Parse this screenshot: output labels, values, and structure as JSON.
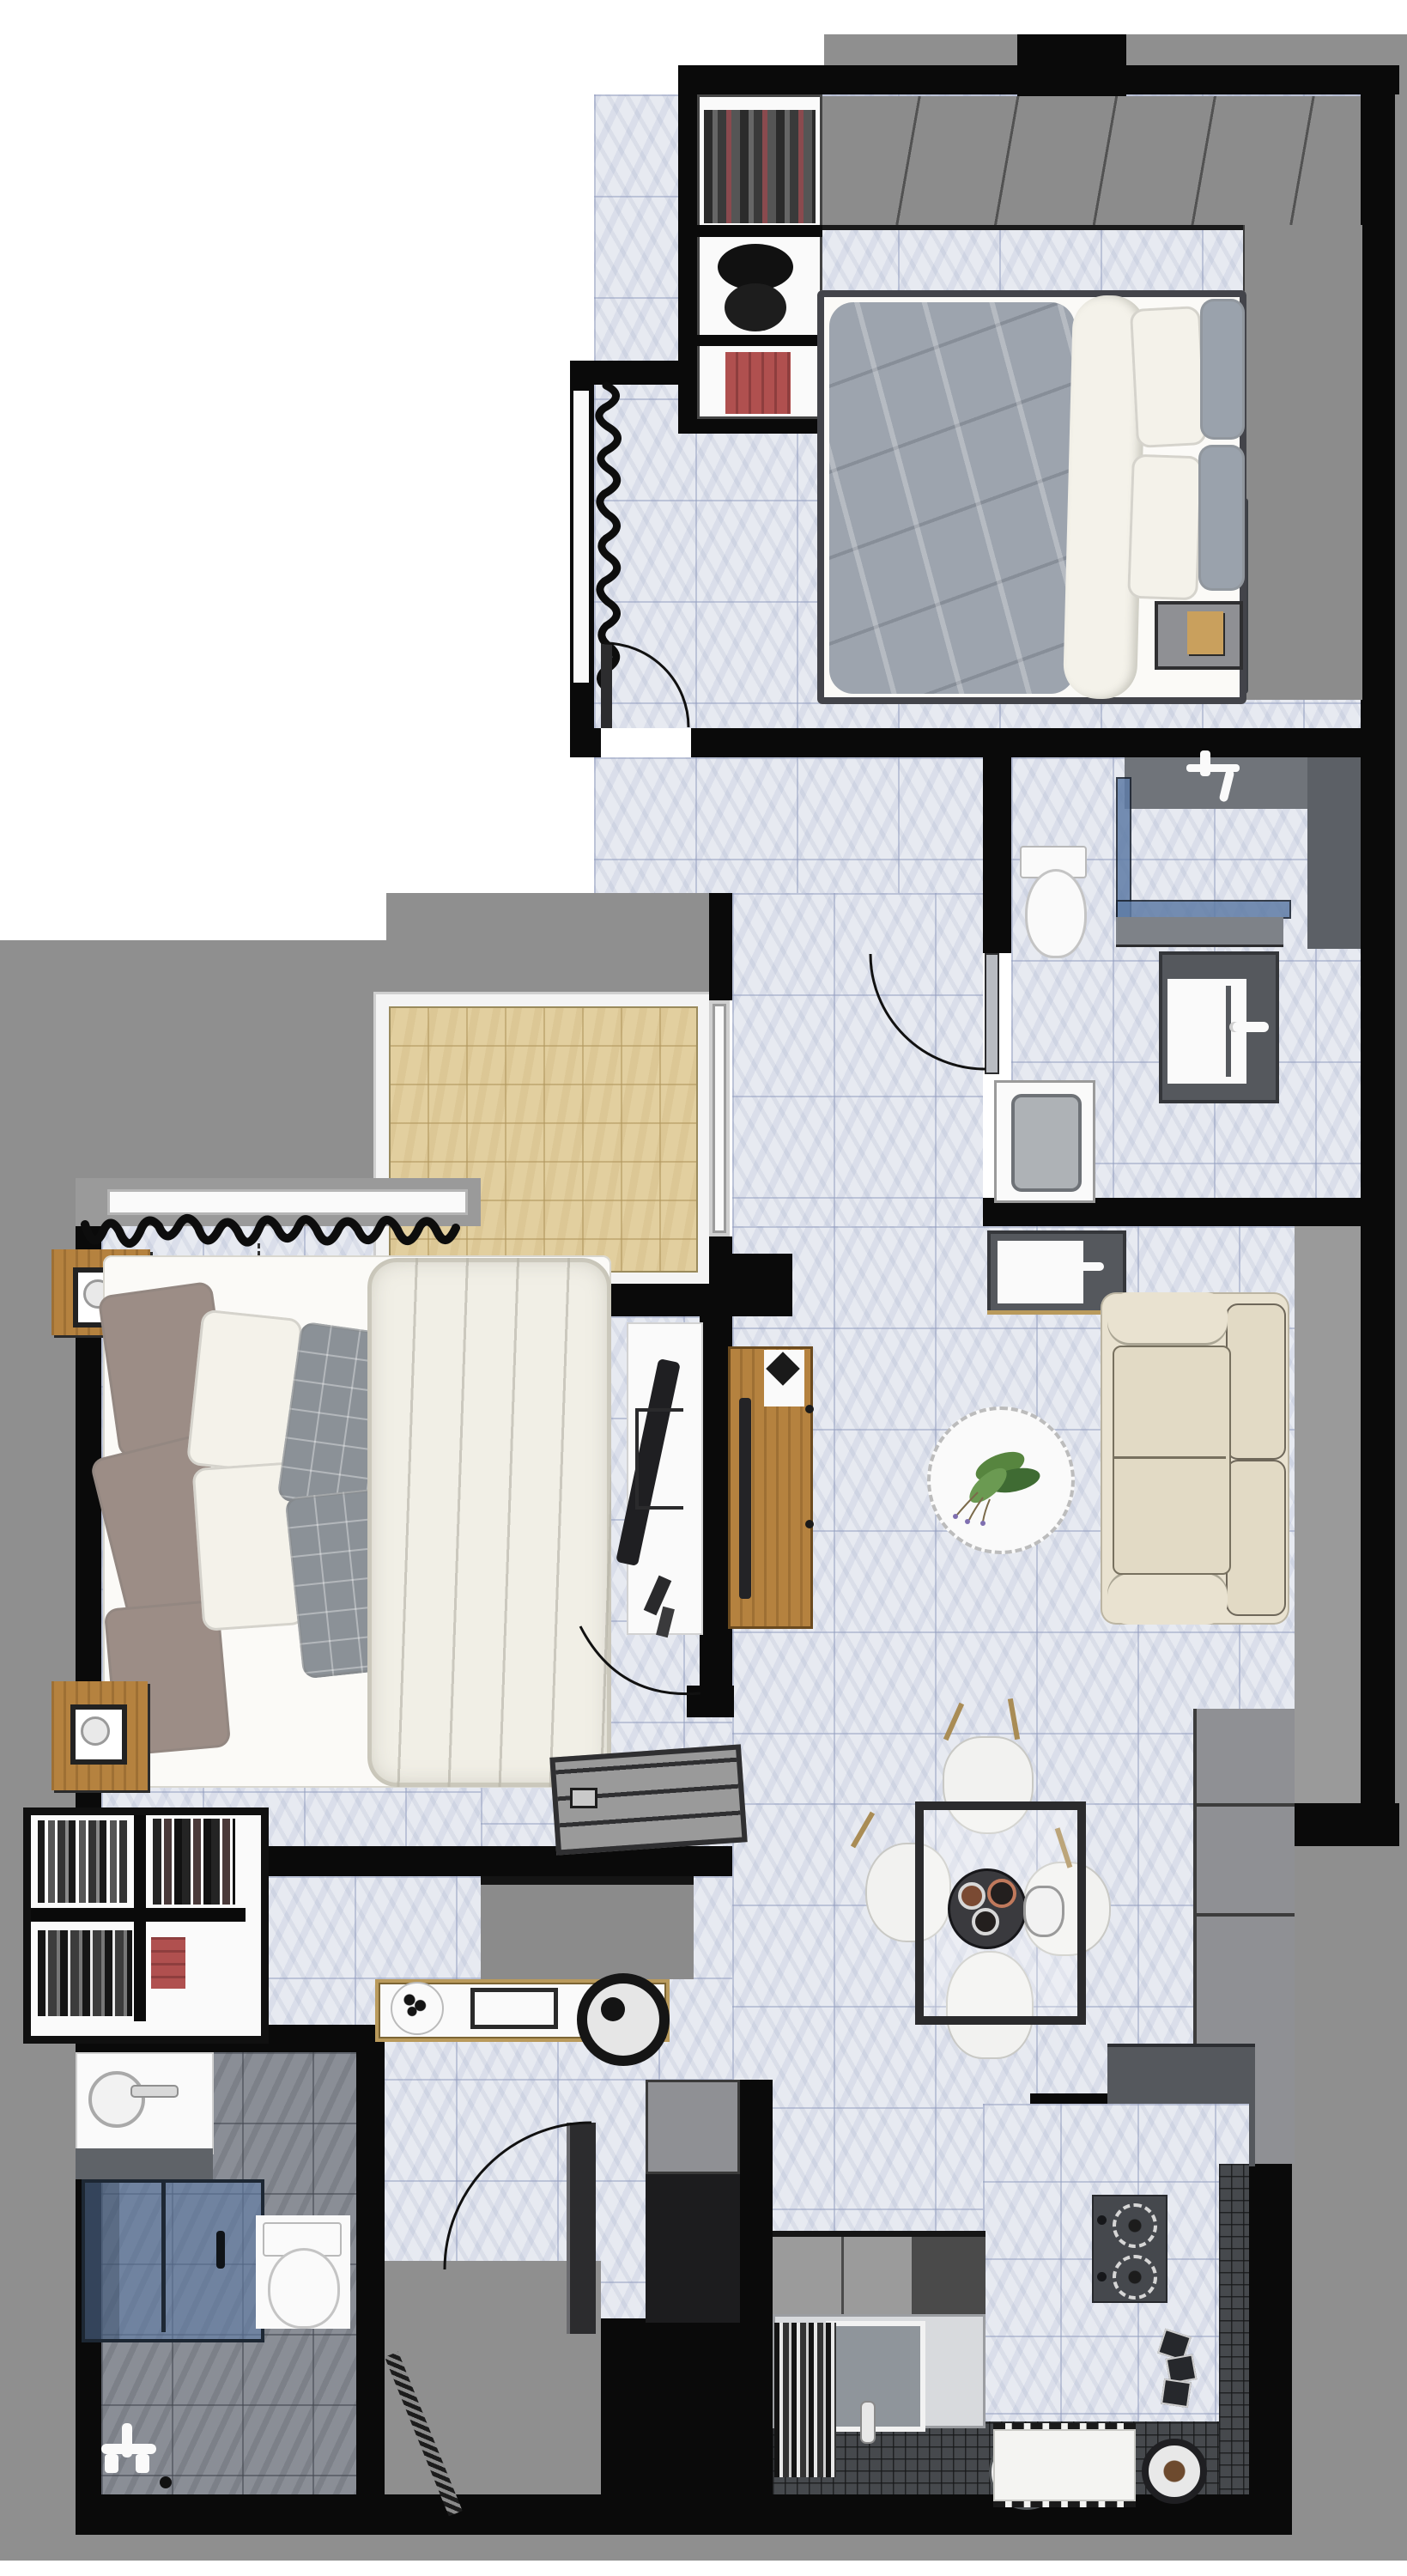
{
  "meta": {
    "title": "Apartment floor plan - top-down 3D render",
    "type": "floor-plan-render",
    "visible_text": []
  },
  "palette": {
    "wall": "#0a0a0a",
    "exterior": "#8f8f8f",
    "sill": "#9a9a9a",
    "marble": "#e7eaf1",
    "balcony": "#e2cf9f",
    "bath-floor": "#8a8e96",
    "mosaic": "#46494d",
    "glass-blue": "#5f7ca6",
    "wood": "#b5823f",
    "wood-light": "#c9a05d",
    "gold": "#b99a5c",
    "sofa": "#e9e2d0",
    "sofa-seat": "#e2dac5",
    "duvet-master": "#f1efe6",
    "duvet-guest": "#9da4ae",
    "blanket": "#f4f2ea",
    "pillow-gray": "#9aa2ac",
    "pillow-taupe": "#9c8d86",
    "plaid": "#8b9197",
    "furn-gray": "#8f9094",
    "counter-dark": "#55585d",
    "white-obj": "#fafafa",
    "stove": "#45484d",
    "plant-a": "#57853f",
    "plant-b": "#3f6b33",
    "plant-c": "#6b9a52",
    "red": "#b0504f",
    "cabinet": "#9b9b9b",
    "door-dark": "#2c2c2e",
    "wardrobe-band": "#8c8c8c"
  },
  "rooms": [
    {
      "id": "bedroom-2",
      "label": "Guest bedroom",
      "furniture": [
        "wardrobe-top-run",
        "closet-shelves",
        "hanging-clothes",
        "hat-stack",
        "red-books",
        "double-bed",
        "gray-duvet",
        "white-blanket",
        "white-pillows",
        "gray-pillows",
        "nightstand",
        "wall-tv",
        "window-curtain",
        "swing-door"
      ]
    },
    {
      "id": "bathroom-1",
      "label": "Upper bathroom",
      "furniture": [
        "shower-faucet",
        "glass-partition",
        "shower-bench",
        "toilet",
        "washing-machine",
        "vanity-sink",
        "swing-door"
      ]
    },
    {
      "id": "balcony",
      "label": "Balcony",
      "furniture": [
        "tile-floor",
        "sliding-glass-door"
      ]
    },
    {
      "id": "corridor",
      "label": "Corridor",
      "furniture": []
    },
    {
      "id": "living-room",
      "label": "Living room",
      "furniture": [
        "sofa",
        "coffee-table",
        "plant",
        "wash-basin-counter",
        "tv-panel",
        "window-ledge"
      ]
    },
    {
      "id": "master-bedroom",
      "label": "Master bedroom",
      "furniture": [
        "window-curtain",
        "nightstand-lamp",
        "double-bed",
        "taupe-pillows",
        "white-pillows",
        "plaid-pillows",
        "fluffy-duvet",
        "media-desk",
        "flat-tv",
        "slatted-bench",
        "bookshelf",
        "wardrobe-block"
      ]
    },
    {
      "id": "entry",
      "label": "Entry hall",
      "furniture": [
        "console-table",
        "decor-tray",
        "picture-frame",
        "wheel-decor",
        "entry-door",
        "entry-porch"
      ]
    },
    {
      "id": "bathroom-2",
      "label": "Master bathroom",
      "furniture": [
        "vanity-sink",
        "shower-enclosure",
        "toilet",
        "floor-faucet",
        "hatched-door"
      ]
    },
    {
      "id": "kitchen",
      "label": "Kitchen",
      "furniture": [
        "refrigerator",
        "stepped-counter",
        "dark-counter",
        "two-burner-stove",
        "kitchen-sink",
        "dish-rack",
        "upper-cabinets",
        "water-jug",
        "fringe-mat",
        "storage-jar",
        "spice-boxes"
      ]
    },
    {
      "id": "dining",
      "label": "Dining area",
      "furniture": [
        "glass-table",
        "chair",
        "chair",
        "chair",
        "chair",
        "serving-tray",
        "cups",
        "kettle"
      ]
    }
  ]
}
